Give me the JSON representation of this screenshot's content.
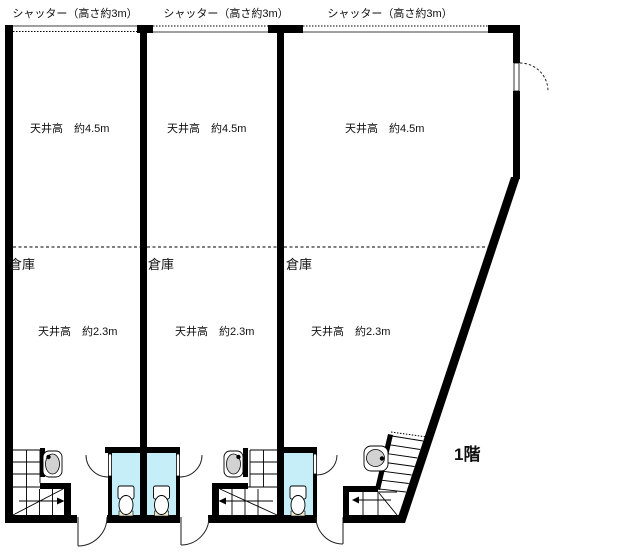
{
  "plan": {
    "floor_label": "1階",
    "units": [
      {
        "shutter_label": "シャッター（高さ約3m）",
        "ceiling_upper": "天井高　約4.5m",
        "room_label": "倉庫",
        "ceiling_lower": "天井高　約2.3m"
      },
      {
        "shutter_label": "シャッター（高さ約3m）",
        "ceiling_upper": "天井高　約4.5m",
        "room_label": "倉庫",
        "ceiling_lower": "天井高　約2.3m"
      },
      {
        "shutter_label": "シャッター（高さ約3m）",
        "ceiling_upper": "天井高　約4.5m",
        "room_label": "倉庫",
        "ceiling_lower": "天井高　約2.3m"
      }
    ],
    "colors": {
      "wall": "#000000",
      "wet_room": "#c6eef8",
      "fixture_beige": "#f0ecd2",
      "sink_gray": "#d2d2d2"
    }
  }
}
